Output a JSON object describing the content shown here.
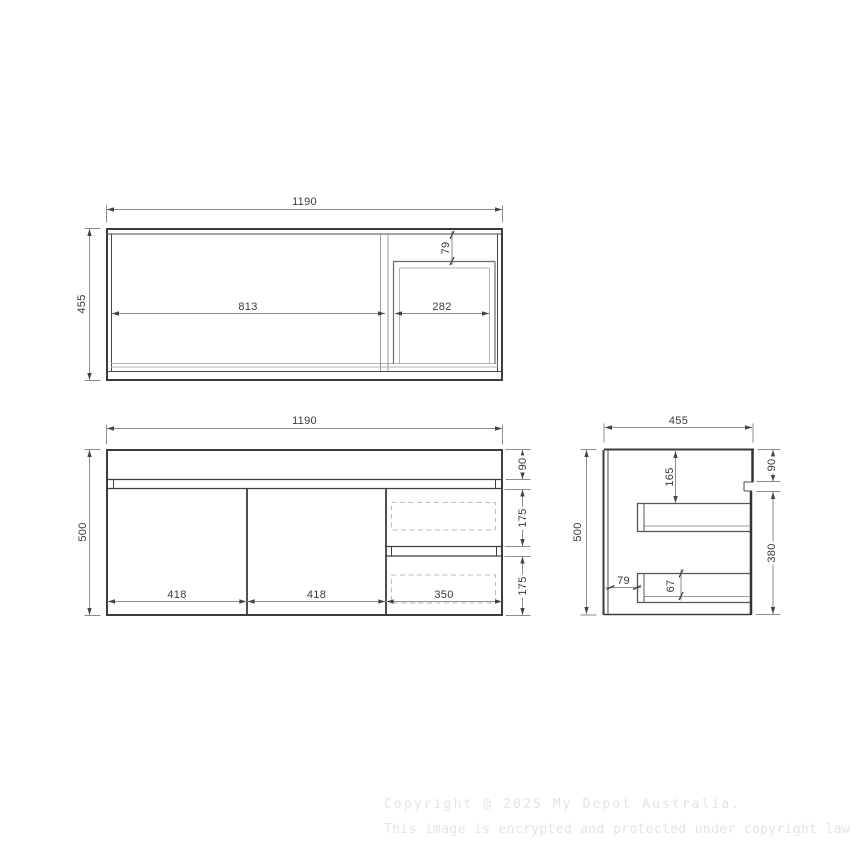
{
  "drawing": {
    "plan_view": {
      "width": "1190",
      "depth": "455",
      "left_section": "813",
      "right_section": "282",
      "drawer_offset": "79"
    },
    "front_view": {
      "width": "1190",
      "height": "500",
      "benchtop_height": "90",
      "drawer_height_top": "175",
      "drawer_height_bottom": "175",
      "door1_width": "418",
      "door2_width": "418",
      "drawer_width": "350"
    },
    "side_view": {
      "depth": "455",
      "height": "500",
      "benchtop_height": "90",
      "cabinet_height": "380",
      "drawer_top_offset": "165",
      "drawer_back_offset": "79",
      "drawer_inner_height": "67"
    }
  },
  "watermark": {
    "line1": "Copyright @ 2025 My Depot Australia.",
    "line2": "This image is encrypted and protected under copyright law."
  }
}
